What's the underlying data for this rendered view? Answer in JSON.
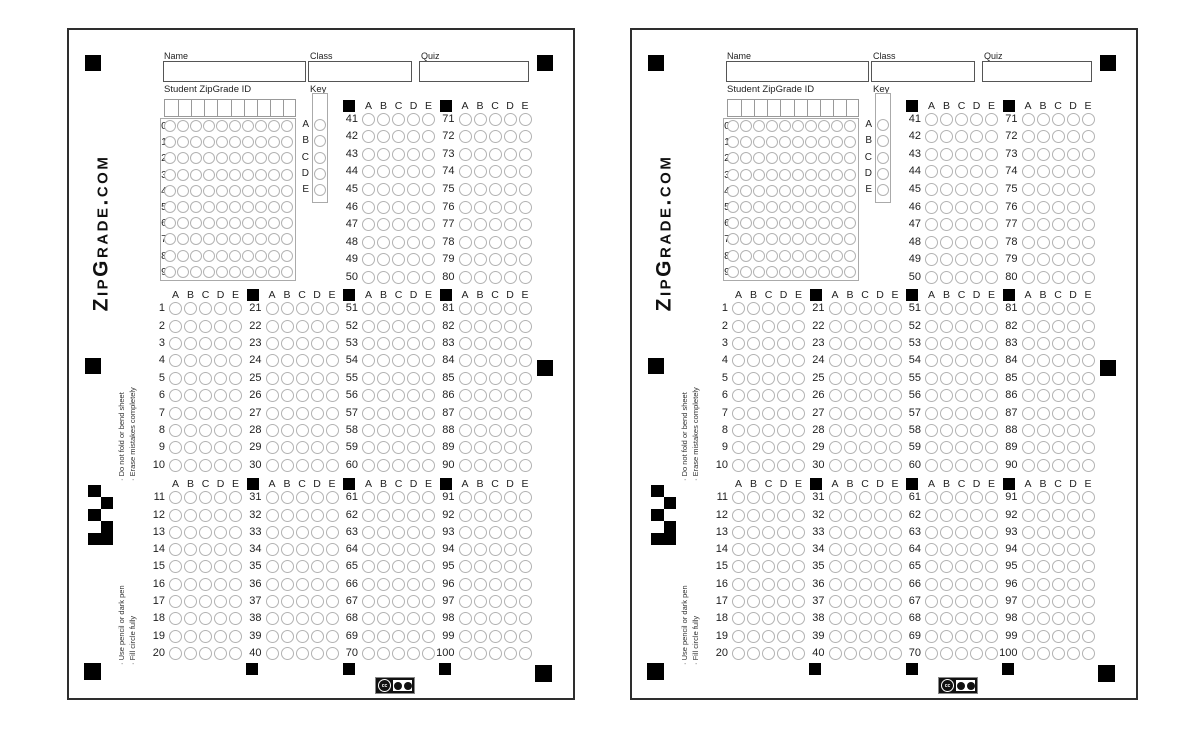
{
  "page": {
    "background": "#ffffff"
  },
  "sheet_count": 2,
  "sheet": {
    "brand": "ZipGrade.com",
    "fields": {
      "name": {
        "label": "Name",
        "value": ""
      },
      "class": {
        "label": "Class",
        "value": ""
      },
      "quiz": {
        "label": "Quiz",
        "value": ""
      }
    },
    "id_section": {
      "label": "Student ZipGrade ID",
      "row_labels": [
        "0",
        "1",
        "2",
        "3",
        "4",
        "5",
        "6",
        "7",
        "8",
        "9"
      ],
      "bubble_columns": 10
    },
    "key_section": {
      "label": "Key",
      "options": [
        "A",
        "B",
        "C",
        "D",
        "E"
      ]
    },
    "answer_letters": [
      "A",
      "B",
      "C",
      "D",
      "E"
    ],
    "question_sections": [
      {
        "name": "top",
        "groups": [
          {
            "start": 41,
            "end": 50,
            "marker": true
          },
          {
            "start": 71,
            "end": 80,
            "marker": true
          }
        ]
      },
      {
        "name": "middle",
        "groups": [
          {
            "start": 1,
            "end": 10,
            "marker": false
          },
          {
            "start": 21,
            "end": 30,
            "marker": true
          },
          {
            "start": 51,
            "end": 60,
            "marker": true
          },
          {
            "start": 81,
            "end": 90,
            "marker": true
          }
        ]
      },
      {
        "name": "bottom",
        "groups": [
          {
            "start": 11,
            "end": 20,
            "marker": false
          },
          {
            "start": 31,
            "end": 40,
            "marker": true
          },
          {
            "start": 61,
            "end": 70,
            "marker": true
          },
          {
            "start": 91,
            "end": 100,
            "marker": true
          }
        ]
      }
    ],
    "instructions": {
      "upper": [
        "· Do not fold or bend sheet",
        "· Erase mistakes completely"
      ],
      "lower": [
        "· Use pencil or dark pen",
        "· Fill circle fully"
      ]
    },
    "license_badge": {
      "icons": [
        "cc-icon",
        "by-icon",
        "sa-icon"
      ]
    },
    "colors": {
      "ink": "#1f1f1f",
      "bubble_outline": "#b3b3b3",
      "sheet_border": "#2e2e2e",
      "registration_mark": "#000000"
    }
  }
}
